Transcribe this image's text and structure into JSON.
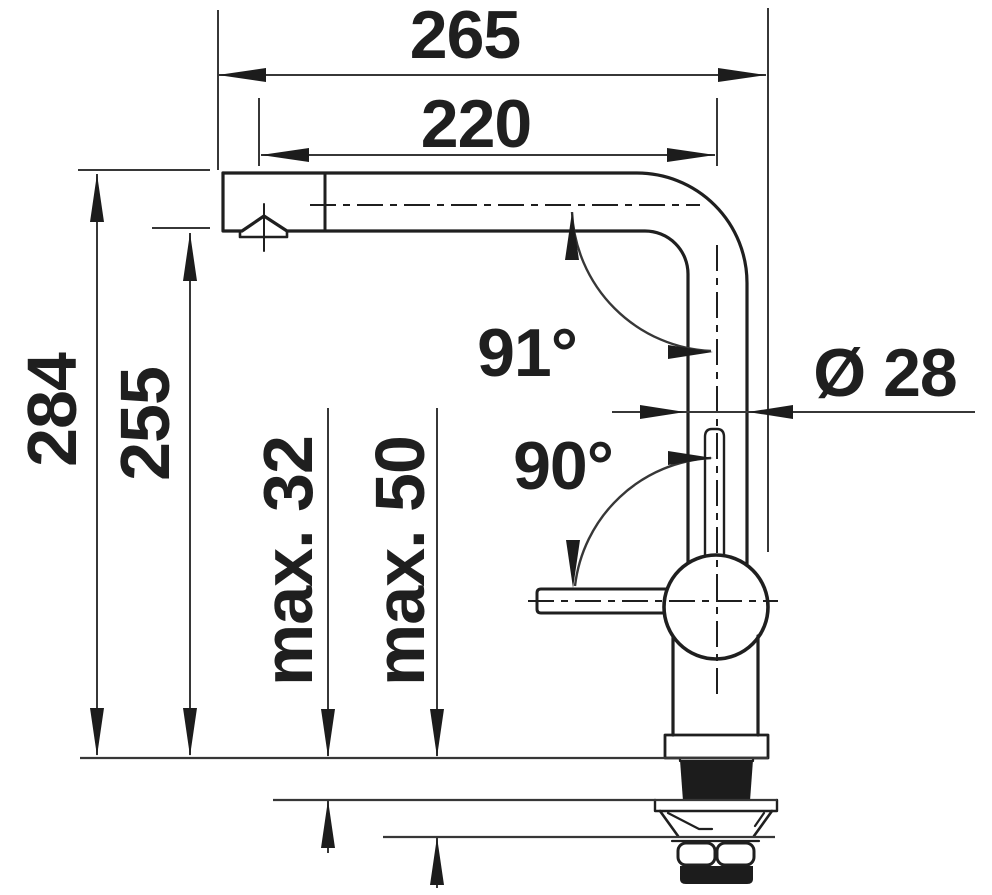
{
  "drawing": {
    "title": "Faucet dimensional line drawing",
    "units": "mm",
    "view": "side elevation of single-lever kitchen tap with L-shaped swivel spout and mounting shank"
  },
  "dimensions": {
    "overall_projection": "265",
    "spout_reach": "220",
    "overall_height": "284",
    "outlet_height": "255",
    "max_counter_thickness": "max. 32",
    "max_clamping_range": "max. 50",
    "spout_angle": "91°",
    "base_angle": "90°",
    "spout_tube_diameter": "Ø 28"
  },
  "colors": {
    "line": "#1f1f1f",
    "dimension_line": "#373737",
    "fill_dark": "#1c1c1c",
    "background": "#ffffff"
  }
}
